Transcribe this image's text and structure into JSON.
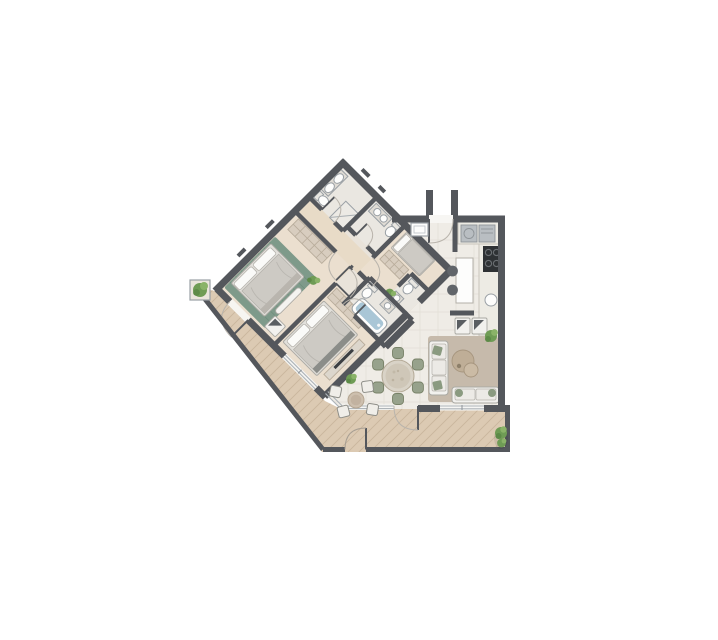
{
  "plan": {
    "kind": "apartment-floor-plan",
    "rooms": [
      {
        "id": "family-bathroom",
        "features": [
          "double-vanity",
          "toilet",
          "shower"
        ]
      },
      {
        "id": "bathroom-2",
        "features": [
          "vanity",
          "toilet"
        ]
      },
      {
        "id": "corridor",
        "features": []
      },
      {
        "id": "master-bedroom",
        "features": [
          "double-bed",
          "wardrobe",
          "bench",
          "armchair",
          "terrace-door"
        ]
      },
      {
        "id": "bedroom-2",
        "features": [
          "double-bed",
          "wardrobe",
          "tv-console",
          "terrace-slider"
        ]
      },
      {
        "id": "ensuite-bathroom",
        "features": [
          "bathtub",
          "toilet",
          "sink"
        ]
      },
      {
        "id": "bedroom-3",
        "features": [
          "single-bed",
          "wardrobe"
        ]
      },
      {
        "id": "bathroom-3",
        "features": [
          "toilet",
          "sink"
        ]
      },
      {
        "id": "entry-hall",
        "features": [
          "entry-door",
          "shaft"
        ]
      },
      {
        "id": "kitchen",
        "features": [
          "counter",
          "cooktop",
          "sink",
          "island",
          "stools",
          "appliances"
        ]
      },
      {
        "id": "living-room",
        "features": [
          "rug",
          "sofa",
          "sofa-2",
          "armchairs",
          "coffee-table",
          "plant"
        ]
      },
      {
        "id": "dining-area",
        "features": [
          "round-table",
          "six-chairs"
        ]
      },
      {
        "id": "terrace",
        "features": [
          "deck",
          "parapet",
          "gate",
          "pouf",
          "stools",
          "planters"
        ]
      }
    ],
    "colors": {
      "wall": "#54575c",
      "wall_light": "#787b80",
      "tile_floor": "#efece6",
      "tile_grid": "#e2ded6",
      "wood_floor": "#ebdfcf",
      "corridor_floor": "#e8dbc7",
      "bath_floor": "#eae7e1",
      "wing_base": "#e9e3da",
      "deck": "#dccab3",
      "deck_line": "#c9b69d",
      "rug_living": "#c6baab",
      "rug_master": "#7e9a8a",
      "rug_master_line": "#6f8d7c",
      "bed_frame": "#e2e0db",
      "mattress": "#cdcac4",
      "pillow": "#fafaf8",
      "wardrobe": "#d8cdbf",
      "wardrobe_line": "#b8ac9b",
      "counter": "#edebe4",
      "appliance": "#b9bec2",
      "cooktop": "#2e3134",
      "tub_water": "#a9c6d6",
      "fixture": "#fdfdfc",
      "fixture_stroke": "#9aa0a5",
      "chair_green": "#97a28c",
      "chair_green_stroke": "#788268",
      "table_top": "#d9d3c7",
      "table_top_inner": "#cfc7b8",
      "coffee_table": "#bfae97",
      "plant_dark": "#5d8a47",
      "plant_mid": "#6f9c55",
      "plant_light": "#8ab368",
      "glass": "#aeb4b8",
      "door_arc": "#b9b4ac",
      "sofa": "#f2f1ee",
      "sofa_stroke": "#a9a9a3",
      "cushion_green": "#8a9a80",
      "pouf": "#cdbfae",
      "background": "#ffffff"
    }
  }
}
